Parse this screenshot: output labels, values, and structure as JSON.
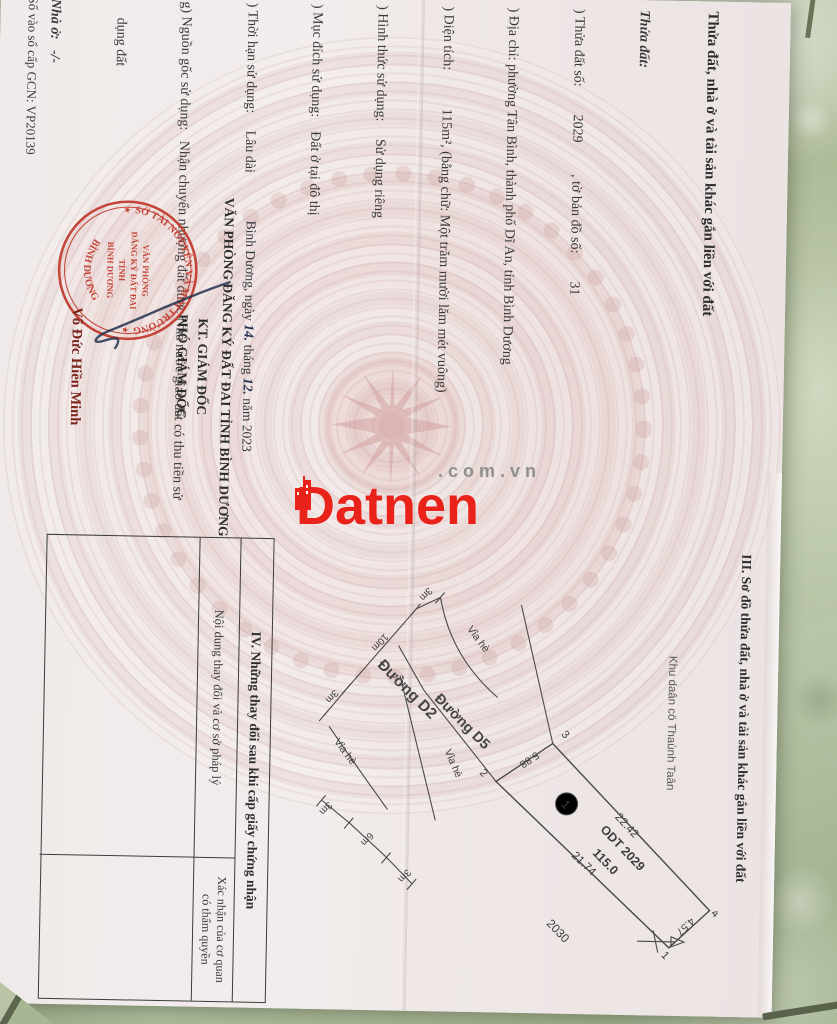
{
  "colors": {
    "tile_green": "#aab893",
    "paper": "#efe8e7",
    "stamp_red": "#c0392b",
    "watermark_red": "#e9221a",
    "drum_pink": "#e4c4c2"
  },
  "watermark": {
    "brand": "Datnen",
    "domain": ".com.vn"
  },
  "certificate": {
    "section_2": {
      "title": "Thửa đất, nhà ở và tài sản khác gắn liền với đất",
      "subtitle": "Thửa đất:",
      "lines": [
        ") Thửa đất số:        2029         , tờ bản đồ số:        31",
        ") Địa chỉ: phường Tân Bình, thành phố Dĩ An, tỉnh Bình Dương",
        ") Diện tích:           115m², (bằng chữ: Một trăm mười lăm mét vuông)",
        ") Hình thức sử dụng:     Sử dụng riêng",
        ") Mục đích sử dụng:    Đất ở tại đô thị",
        ") Thời hạn sử dụng:     Lâu dài",
        "g) Nguồn gốc sử dụng:   Nhận chuyển nhượng đất được Nhà nước giao đất có thu tiền sử",
        "     dụng đất",
        "Nhà ở:   -/-",
        "Công trình xây dựng khác: -/-",
        "Rừng sản xuất là rừng trồng: -/-",
        "Cây lâu năm:   -/-",
        "Ghi chú:",
        "Thửa đất thuộc Ô 1, lô G - Khu nhà ở Đất Mới,",
        "Nhận chuyển nhượng quyền sử dụng đất từ Công ty Cổ phần Đất Mới."
      ]
    },
    "section_3": {
      "title": "III. Sơ đồ thửa đất, nhà ở và tài sản khác gắn liền với đất",
      "area_label": "Khu daân cö Thaùnh Taân"
    },
    "diagram": {
      "roads": {
        "d2": "Đường D2",
        "d5": "Đường D5"
      },
      "sidewalk": "Vỉa hè",
      "dims": {
        "d2_widths": [
          "3m",
          "10m",
          "3m"
        ],
        "frontage_widths": [
          "3m",
          "6m",
          "3m"
        ]
      },
      "parcel": {
        "index": "1",
        "land_use_line1": "ODT  2029",
        "land_use_line2": "115.0",
        "vertices": {
          "v1": "1",
          "v2": "2",
          "v3": "3",
          "v4": "4"
        },
        "edges": {
          "e12": "21.74",
          "e23": "5.88",
          "e34": "22.42",
          "e41": "4.57"
        }
      },
      "neighbor_parcel": "2030"
    },
    "signing": {
      "place": "Bình Dương, ngày",
      "day": "14.",
      "thang": "tháng",
      "month": "12.",
      "nam": "năm 2023",
      "office": "VĂN PHÒNG ĐĂNG KÝ ĐẤT ĐAI TỈNH BÌNH DƯƠNG",
      "kt": "KT. GIÁM ĐỐC",
      "position": "PHÓ GIÁM ĐỐC",
      "signer": "Võ Đức Hiền Minh",
      "stamp": {
        "ring_top": "SỞ TÀI NGUYÊN VÀ MÔI TRƯỜNG",
        "ring_bottom": "BÌNH DƯƠNG",
        "star": "★",
        "center": [
          "VĂN PHÒNG",
          "ĐĂNG KÝ ĐẤT ĐAI",
          "TỈNH",
          "BÌNH DƯƠNG"
        ]
      }
    },
    "registry_no": "Số vào sổ cấp GCN: VP20139",
    "section_4": {
      "title": "IV. Những thay đổi sau khi cấp giấy chứng nhận",
      "col_content": "Nội dung thay đổi và cơ sở pháp lý",
      "col_confirm": "Xác nhận của cơ quan\ncó thẩm quyền"
    }
  }
}
